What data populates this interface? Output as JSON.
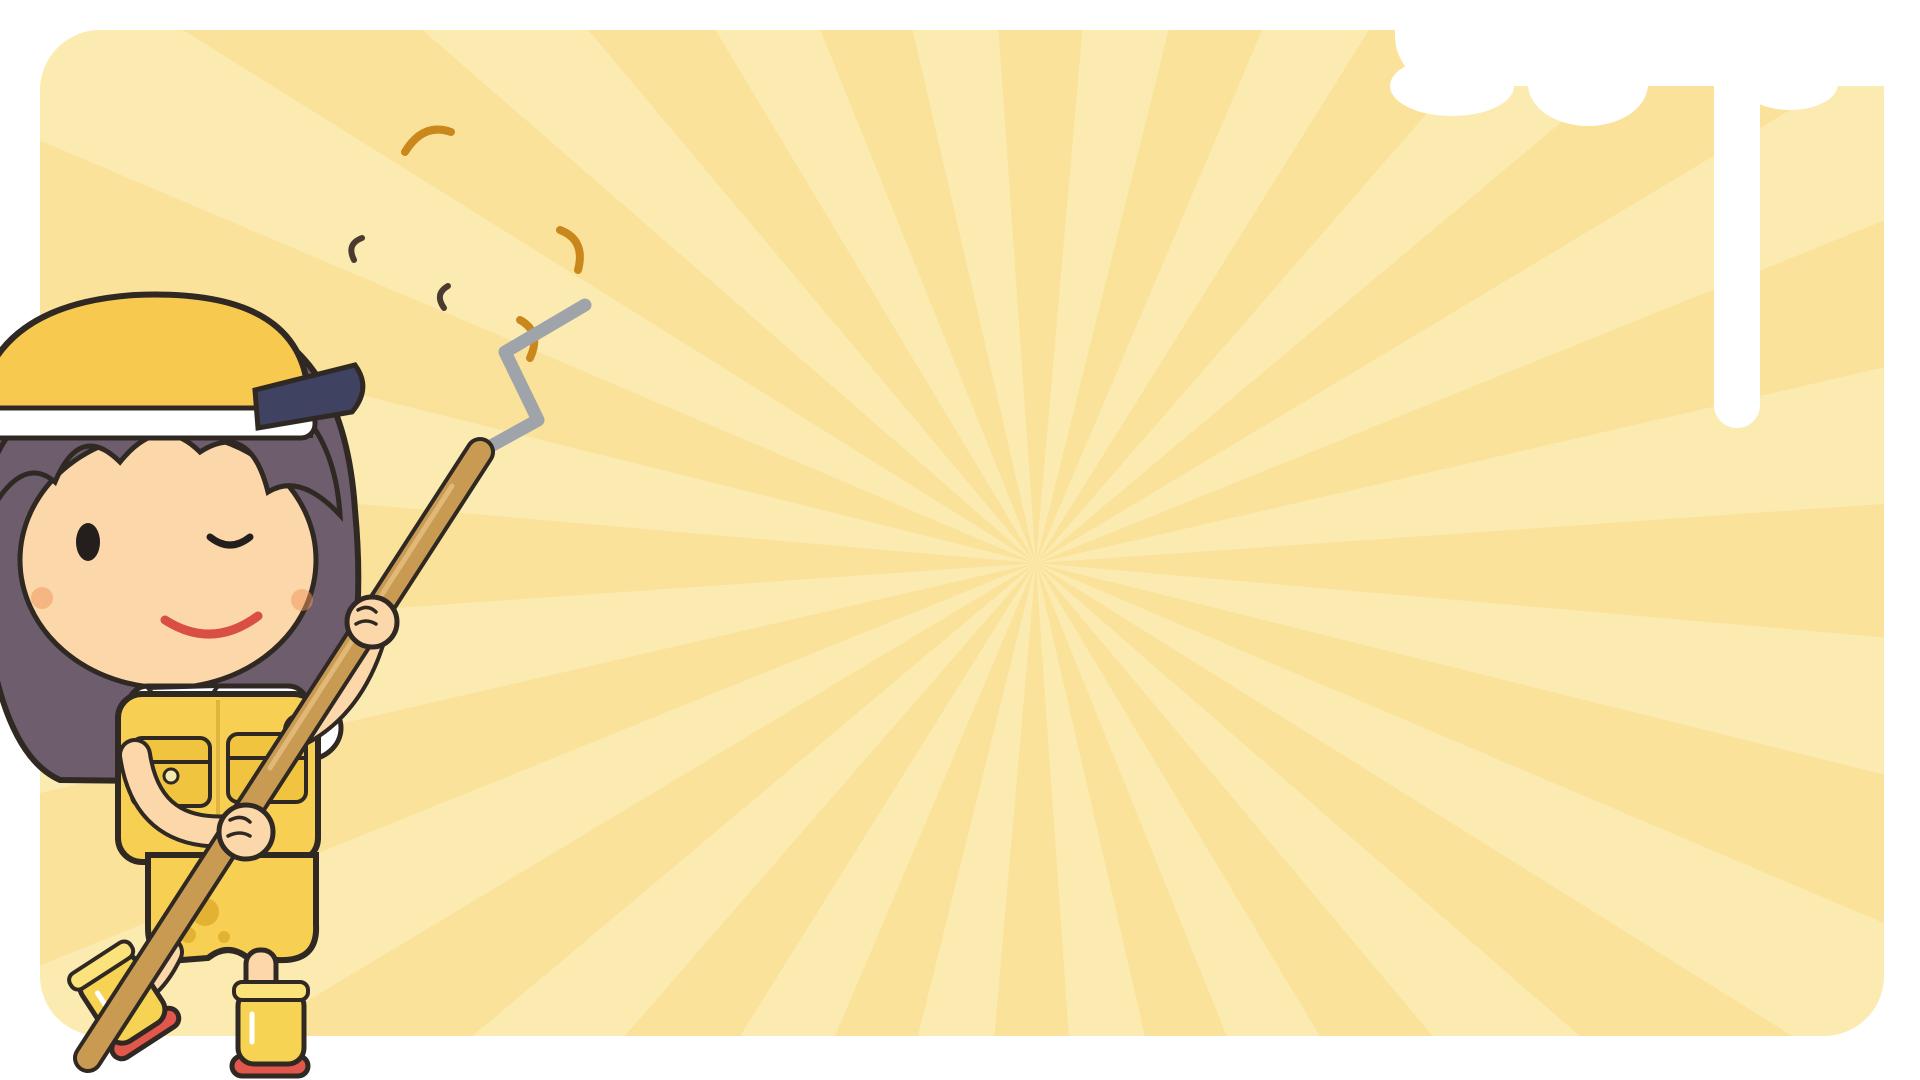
{
  "texts": {
    "happy": "HAPPY"
  },
  "colors": {
    "page_bg": "#ffffff",
    "panel_yellow": "#fbe29a",
    "panel_ray": "#fcebb0",
    "outline": "#2f2823",
    "accent_yellow": "#f6cf57",
    "wood": "#c98f4e",
    "copper": "#c0763a",
    "white": "#fcfbf5",
    "glass_blue": "#cdeaf4",
    "pink": "#f3a8c8",
    "teal": "#57cfa8",
    "grey": "#9aa2ad",
    "green": "#6fae4e",
    "boot_sole_red": "#e2574b",
    "hair_purple": "#6e5e6d",
    "skin": "#fcd7a9",
    "happy_green": "#2f9e3c"
  },
  "character": {
    "name": "painter-girl",
    "outfit": [
      "yellow-visor",
      "white-shirt",
      "yellow-overalls",
      "yellow-rain-boots"
    ],
    "holding": "paint-roller",
    "expression": "wink-smile"
  },
  "items": [
    {
      "n": "display-cabinet",
      "k": "glasscab",
      "x": 68,
      "y": 94,
      "w": 140,
      "h": 242
    },
    {
      "n": "table-lamp",
      "k": "lampT",
      "x": 196,
      "y": 110,
      "w": 48,
      "h": 66
    },
    {
      "n": "pendant-lamp",
      "k": "pendant",
      "x": 200,
      "y": 178,
      "w": 44,
      "h": 104
    },
    {
      "n": "lavender-vase",
      "k": "vasef",
      "x": 252,
      "y": 110,
      "w": 46,
      "h": 96,
      "p": {
        "t": "lav",
        "v": "#2e7d5b"
      }
    },
    {
      "n": "daisy-flower-stand",
      "k": "fstand",
      "x": 246,
      "y": 208,
      "w": 64,
      "h": 132
    },
    {
      "n": "large-tree",
      "k": "treeL",
      "x": 290,
      "y": 86,
      "w": 198,
      "h": 408
    },
    {
      "n": "hanging-plant",
      "k": "hplant",
      "x": 482,
      "y": 112,
      "w": 52,
      "h": 64
    },
    {
      "n": "arc-floor-lamp",
      "k": "lampArc",
      "x": 640,
      "y": 130,
      "w": 82,
      "h": 348
    },
    {
      "n": "hutch-cabinet",
      "k": "hutch",
      "x": 736,
      "y": 124,
      "w": 136,
      "h": 196
    },
    {
      "n": "garment-cart",
      "k": "cart",
      "x": 556,
      "y": 336,
      "w": 188,
      "h": 162
    },
    {
      "n": "high-chair",
      "k": "hichair",
      "x": 814,
      "y": 318,
      "w": 58,
      "h": 80
    },
    {
      "n": "pedestal-sink",
      "k": "psink",
      "x": 918,
      "y": 138,
      "w": 118,
      "h": 120
    },
    {
      "n": "shower-curtain-rail",
      "k": "srail",
      "x": 886,
      "y": 238,
      "w": 166,
      "h": 155
    },
    {
      "n": "window-cabinet",
      "k": "winunit",
      "x": 1066,
      "y": 146,
      "w": 170,
      "h": 97
    },
    {
      "n": "wooden-brush",
      "k": "tool",
      "x": 1078,
      "y": 250,
      "w": 58,
      "h": 28,
      "p": {
        "t": "spoonh"
      }
    },
    {
      "n": "toothpaste-purple",
      "k": "tube",
      "x": 1184,
      "y": 264,
      "w": 20,
      "h": 38,
      "p": {
        "c": "#8f7fd0"
      }
    },
    {
      "n": "toothpaste-pink",
      "k": "tube",
      "x": 1210,
      "y": 264,
      "w": 20,
      "h": 38,
      "p": {
        "c": "#e0568e"
      }
    },
    {
      "n": "oval-mirror",
      "k": "movel",
      "x": 1254,
      "y": 144,
      "w": 74,
      "h": 90,
      "p": {
        "dots": 1
      }
    },
    {
      "n": "flower-wreath",
      "k": "wreath",
      "x": 1342,
      "y": 150,
      "w": 56,
      "h": 74
    },
    {
      "n": "egg-pennant-banner",
      "k": "garland",
      "x": 1246,
      "y": 241,
      "w": 118,
      "h": 50,
      "p": {
        "t": "eggban"
      }
    },
    {
      "n": "daisy-frame-small",
      "k": "framer",
      "x": 1364,
      "y": 291,
      "w": 34,
      "h": 46,
      "p": {
        "f": "#ccd052",
        "t": "daisy"
      }
    },
    {
      "n": "detergent-blue",
      "k": "bottle",
      "x": 1238,
      "y": 300,
      "w": 36,
      "h": 54,
      "p": {
        "c": "#7fd0e8",
        "cap": "#d33f3f"
      }
    },
    {
      "n": "detergent-white",
      "k": "bottle",
      "x": 1282,
      "y": 296,
      "w": 42,
      "h": 58,
      "p": {
        "c": "#f2f6f8",
        "cap": "#e0568e"
      }
    },
    {
      "n": "soap-pump-brown",
      "k": "pump",
      "x": 1256,
      "y": 364,
      "w": 28,
      "h": 54,
      "p": {
        "c": "#cfae7c"
      }
    },
    {
      "n": "soap-pump-pink",
      "k": "pump",
      "x": 1298,
      "y": 369,
      "w": 28,
      "h": 50,
      "p": {
        "c": "#f3bfd3"
      }
    },
    {
      "n": "ladder-shelf",
      "k": "ladder",
      "x": 1418,
      "y": 154,
      "w": 80,
      "h": 182
    },
    {
      "n": "yellow-curtain",
      "k": "curtain",
      "x": 1532,
      "y": 124,
      "w": 80,
      "h": 312
    },
    {
      "n": "flower-clock",
      "k": "eggf",
      "x": 1642,
      "y": 140,
      "w": 60,
      "h": 60
    },
    {
      "n": "lace-shelf-trim",
      "k": "lace",
      "x": 1746,
      "y": 145,
      "w": 92,
      "h": 32
    },
    {
      "n": "toaster-oven",
      "k": "micro",
      "x": 1614,
      "y": 211,
      "w": 90,
      "h": 74
    },
    {
      "n": "wall-shelf-small",
      "k": "wshelf",
      "x": 1762,
      "y": 208,
      "w": 88,
      "h": 28
    },
    {
      "n": "wall-shelf-large",
      "k": "wshelf",
      "x": 1758,
      "y": 264,
      "w": 94,
      "h": 36
    },
    {
      "n": "egg-fluffy-rug",
      "k": "rug",
      "x": 1622,
      "y": 313,
      "w": 182,
      "h": 66,
      "p": {
        "t": "egg"
      }
    },
    {
      "n": "oval-frame-small",
      "k": "movel",
      "x": 1816,
      "y": 328,
      "w": 36,
      "h": 48,
      "p": {
        "fl": 1
      }
    },
    {
      "n": "hearts-frame",
      "k": "framer",
      "x": 1624,
      "y": 394,
      "w": 56,
      "h": 44,
      "p": {
        "f": "#7a4a32",
        "t": "hearts"
      }
    },
    {
      "n": "writing-desk",
      "k": "desk",
      "x": 1696,
      "y": 391,
      "w": 164,
      "h": 92
    },
    {
      "n": "star-rug",
      "k": "rug",
      "x": 1383,
      "y": 443,
      "w": 308,
      "h": 80,
      "p": {
        "t": "stars"
      }
    },
    {
      "n": "round-cloth-table",
      "k": "tround",
      "x": 1564,
      "y": 536,
      "w": 138,
      "h": 92
    },
    {
      "n": "bowl-blue",
      "k": "bowl",
      "x": 1710,
      "y": 516,
      "w": 42,
      "h": 30,
      "p": {
        "c": "#7f9fd6",
        "rim": "#ffffff"
      }
    },
    {
      "n": "bowl-teal",
      "k": "bowl",
      "x": 1712,
      "y": 564,
      "w": 44,
      "h": 32,
      "p": {
        "c": "#bfe3df",
        "rim": "#e8f4f2"
      }
    },
    {
      "n": "egg-art-box",
      "k": "boxart",
      "x": 1770,
      "y": 506,
      "w": 88,
      "h": 74
    },
    {
      "n": "egg-garland",
      "k": "garland",
      "x": 1684,
      "y": 594,
      "w": 174,
      "h": 54,
      "p": {
        "t": "eggs"
      }
    },
    {
      "n": "storage-box",
      "k": "boxs",
      "x": 1558,
      "y": 656,
      "w": 54,
      "h": 34
    },
    {
      "n": "daisy-rug",
      "k": "rug",
      "x": 1630,
      "y": 650,
      "w": 172,
      "h": 64,
      "p": {
        "t": "daisy"
      }
    },
    {
      "n": "laptop",
      "k": "laptop",
      "x": 1808,
      "y": 650,
      "w": 54,
      "h": 52
    },
    {
      "n": "pet-bed-yellow",
      "k": "petbed",
      "x": 1488,
      "y": 696,
      "w": 96,
      "h": 72,
      "p": {
        "t": "donut"
      }
    },
    {
      "n": "pansy-pot",
      "k": "vasef",
      "x": 1586,
      "y": 696,
      "w": 48,
      "h": 60,
      "p": {
        "t": "pansy",
        "v": "#f3b8cc"
      }
    },
    {
      "n": "pouf",
      "k": "petbed",
      "x": 1640,
      "y": 718,
      "w": 72,
      "h": 42,
      "p": {
        "t": "pouf"
      }
    },
    {
      "n": "towel-rail",
      "k": "rail",
      "x": 1748,
      "y": 728,
      "w": 112,
      "h": 32,
      "p": {
        "c": "#aeb8c2"
      }
    },
    {
      "n": "coat-rack",
      "k": "rail",
      "x": 1560,
      "y": 786,
      "w": 98,
      "h": 28,
      "p": {
        "c": "#cf9a58",
        "wood": 1
      }
    },
    {
      "n": "flower-mirror",
      "k": "mirf",
      "x": 1680,
      "y": 748,
      "w": 94,
      "h": 94
    },
    {
      "n": "lace-pillow",
      "k": "pillow",
      "x": 1796,
      "y": 790,
      "w": 58,
      "h": 50
    },
    {
      "n": "blue-pot",
      "k": "small",
      "x": 1602,
      "y": 826,
      "w": 28,
      "h": 26,
      "p": {
        "t": "pot"
      }
    },
    {
      "n": "two-tier-shelf",
      "k": "shelf2",
      "x": 1560,
      "y": 853,
      "w": 154,
      "h": 92
    },
    {
      "n": "wooden-display-box",
      "k": "sbox",
      "x": 1730,
      "y": 856,
      "w": 128,
      "h": 84
    },
    {
      "n": "wide-wall-mirror",
      "k": "sbox",
      "x": 1348,
      "y": 606,
      "w": 204,
      "h": 78,
      "p": {
        "g": "#b9b9b2"
      }
    },
    {
      "n": "fridge-yellow",
      "k": "fridge",
      "x": 1092,
      "y": 604,
      "w": 112,
      "h": 232
    },
    {
      "n": "vanity-sink",
      "k": "vanity",
      "x": 1044,
      "y": 290,
      "w": 152,
      "h": 172
    },
    {
      "n": "wall-cabinet",
      "k": "wallcab",
      "x": 1370,
      "y": 353,
      "w": 104,
      "h": 85
    },
    {
      "n": "step-stool",
      "k": "sstool",
      "x": 1244,
      "y": 420,
      "w": 104,
      "h": 102
    },
    {
      "n": "frying-pan",
      "k": "pan",
      "x": 1140,
      "y": 434,
      "w": 76,
      "h": 30
    },
    {
      "n": "washer-cream",
      "k": "washer",
      "x": 1146,
      "y": 468,
      "w": 86,
      "h": 110
    },
    {
      "n": "pink-jar",
      "k": "small",
      "x": 1370,
      "y": 534,
      "w": 34,
      "h": 28,
      "p": {
        "t": "jar"
      }
    },
    {
      "n": "lunchbox-pink",
      "k": "small",
      "x": 1366,
      "y": 564,
      "w": 46,
      "h": 32,
      "p": {
        "t": "lunch"
      }
    },
    {
      "n": "toy-ball",
      "k": "small",
      "x": 1418,
      "y": 572,
      "w": 22,
      "h": 22,
      "p": {
        "t": "ball"
      }
    },
    {
      "n": "mug-blue",
      "k": "cup",
      "x": 1436,
      "y": 530,
      "w": 34,
      "h": 34,
      "p": {
        "t": "mug",
        "c": "#8fb8e8"
      }
    },
    {
      "n": "mug-yellow",
      "k": "cup",
      "x": 1450,
      "y": 558,
      "w": 36,
      "h": 32,
      "p": {
        "t": "mug",
        "c": "#f6cf57"
      }
    },
    {
      "n": "toothbrush-pink",
      "k": "tool",
      "x": 1485,
      "y": 533,
      "w": 14,
      "h": 48,
      "p": {
        "t": "tbrush",
        "c": "#f08ab8"
      }
    },
    {
      "n": "toothbrush-yellow",
      "k": "tool",
      "x": 1507,
      "y": 533,
      "w": 14,
      "h": 48,
      "p": {
        "t": "tbrush",
        "c": "#e8c24e"
      }
    },
    {
      "n": "potted-tree",
      "k": "treeP",
      "x": 1246,
      "y": 550,
      "w": 112,
      "h": 150
    },
    {
      "n": "daisy-vase",
      "k": "vasef",
      "x": 1208,
      "y": 580,
      "w": 40,
      "h": 58,
      "p": {
        "t": "daisy",
        "v": "#eef3ee"
      }
    },
    {
      "n": "small-lamp",
      "k": "lampT",
      "x": 1208,
      "y": 660,
      "w": 46,
      "h": 58,
      "p": {
        "sh": "#f6cf57",
        "b": "#e8955c"
      }
    },
    {
      "n": "wooden-bench",
      "k": "bench",
      "x": 1328,
      "y": 706,
      "w": 152,
      "h": 62
    },
    {
      "n": "pennant-banner-blue",
      "k": "garland",
      "x": 1394,
      "y": 784,
      "w": 116,
      "h": 46,
      "p": {
        "t": "bluyel"
      }
    },
    {
      "n": "happy-garland",
      "k": "garland",
      "x": 1364,
      "y": 820,
      "w": 190,
      "h": 62,
      "p": {
        "t": "happy"
      }
    },
    {
      "n": "stove-oven",
      "k": "stove",
      "x": 1208,
      "y": 738,
      "w": 116,
      "h": 204
    },
    {
      "n": "kitchen-sink-cabinet",
      "k": "sinkcab",
      "x": 998,
      "y": 806,
      "w": 180,
      "h": 138
    },
    {
      "n": "pedestal-side-table",
      "k": "tped",
      "x": 1328,
      "y": 854,
      "w": 52,
      "h": 42
    },
    {
      "n": "saucepan",
      "k": "sauce",
      "x": 1336,
      "y": 904,
      "w": 82,
      "h": 42
    },
    {
      "n": "pink-sponge",
      "k": "small",
      "x": 1430,
      "y": 884,
      "w": 32,
      "h": 22,
      "p": {
        "t": "sponge"
      }
    },
    {
      "n": "plate-blue",
      "k": "bowl",
      "x": 1484,
      "y": 878,
      "w": 56,
      "h": 22,
      "p": {
        "flat": 1,
        "c": "#fdfdf6",
        "in": "#cfe0f0"
      }
    },
    {
      "n": "bowl-yellow",
      "k": "bowl",
      "x": 1420,
      "y": 918,
      "w": 52,
      "h": 24,
      "p": {
        "c": "#f6cf57",
        "rim": "#e8f0f2"
      }
    },
    {
      "n": "plate-yellow",
      "k": "bowl",
      "x": 1486,
      "y": 912,
      "w": 48,
      "h": 28,
      "p": {
        "flat": 1,
        "c": "#fdfdf6",
        "in": "#f6cf57"
      }
    },
    {
      "n": "toilet",
      "k": "toilet",
      "x": 1068,
      "y": 461,
      "w": 60,
      "h": 114
    },
    {
      "n": "armchair-yellow",
      "k": "chair",
      "x": 848,
      "y": 490,
      "w": 112,
      "h": 174
    },
    {
      "n": "stand-mixer",
      "k": "mixer",
      "x": 978,
      "y": 490,
      "w": 48,
      "h": 82
    },
    {
      "n": "soap-dish",
      "k": "dishk",
      "x": 968,
      "y": 548,
      "w": 58,
      "h": 32
    },
    {
      "n": "hoop-daisy",
      "k": "hoop",
      "x": 1032,
      "y": 563,
      "w": 44,
      "h": 52,
      "p": {
        "t": "daisy"
      }
    },
    {
      "n": "hoop-dots",
      "k": "hoop",
      "x": 982,
      "y": 594,
      "w": 46,
      "h": 54,
      "p": {
        "t": "dots"
      }
    },
    {
      "n": "striped-cup",
      "k": "cup",
      "x": 1042,
      "y": 625,
      "w": 30,
      "h": 30,
      "p": {
        "t": "tilt"
      }
    },
    {
      "n": "table-blue",
      "k": "table4",
      "x": 838,
      "y": 608,
      "w": 128,
      "h": 86
    },
    {
      "n": "washer-dark",
      "k": "washer",
      "x": 668,
      "y": 488,
      "w": 88,
      "h": 106,
      "p": {
        "dark": 1
      }
    },
    {
      "n": "mug-pink",
      "k": "cup",
      "x": 613,
      "y": 493,
      "w": 32,
      "h": 32,
      "p": {
        "t": "mug",
        "c": "#f3a8c8"
      }
    },
    {
      "n": "teacup-dotted",
      "k": "cup",
      "x": 608,
      "y": 542,
      "w": 38,
      "h": 32,
      "p": {
        "t": "tea",
        "c": "#fdfdf6"
      }
    },
    {
      "n": "teacup-pink",
      "k": "cup",
      "x": 606,
      "y": 588,
      "w": 40,
      "h": 34,
      "p": {
        "t": "tea",
        "c": "#f3a8c8"
      }
    },
    {
      "n": "rice-cooker",
      "k": "ricec",
      "x": 446,
      "y": 526,
      "w": 46,
      "h": 48
    },
    {
      "n": "nightstand",
      "k": "nstand",
      "x": 423,
      "y": 588,
      "w": 90,
      "h": 80
    },
    {
      "n": "twin-floor-lamp",
      "k": "lamp2",
      "x": 528,
      "y": 500,
      "w": 66,
      "h": 148
    },
    {
      "n": "plaid-rug-blue",
      "k": "rug",
      "x": 596,
      "y": 620,
      "w": 224,
      "h": 70,
      "p": {
        "t": "plaid"
      }
    },
    {
      "n": "daisy-planter",
      "k": "planter",
      "x": 620,
      "y": 688,
      "w": 90,
      "h": 54
    },
    {
      "n": "pet-chair-pink",
      "k": "petbed",
      "x": 656,
      "y": 713,
      "w": 126,
      "h": 94,
      "p": {
        "t": "pinkchair"
      }
    },
    {
      "n": "egg-clock",
      "k": "clockegg",
      "x": 748,
      "y": 808,
      "w": 54,
      "h": 56
    },
    {
      "n": "bookshelf",
      "k": "bookshelf",
      "x": 808,
      "y": 706,
      "w": 164,
      "h": 300
    },
    {
      "n": "sofa-yellow",
      "k": "sofa",
      "x": 556,
      "y": 850,
      "w": 224,
      "h": 154
    },
    {
      "n": "standing-mirror",
      "k": "mirst",
      "x": 402,
      "y": 796,
      "w": 72,
      "h": 208
    },
    {
      "n": "doll-bed",
      "k": "dollbed",
      "x": 280,
      "y": 796,
      "w": 142,
      "h": 212
    },
    {
      "n": "tv-stand",
      "k": "tvstand",
      "x": 420,
      "y": 680,
      "w": 154,
      "h": 82
    },
    {
      "n": "low-table",
      "k": "tlow",
      "x": 478,
      "y": 788,
      "w": 150,
      "h": 36
    },
    {
      "n": "small-stool-table",
      "k": "stoolsm",
      "x": 614,
      "y": 880,
      "w": 60,
      "h": 120
    },
    {
      "n": "wooden-spoon",
      "k": "tool",
      "x": 968,
      "y": 653,
      "w": 32,
      "h": 62,
      "p": {
        "t": "spoon"
      }
    },
    {
      "n": "kitchen-knife",
      "k": "tool",
      "x": 1004,
      "y": 652,
      "w": 24,
      "h": 54,
      "p": {
        "t": "knife"
      }
    },
    {
      "n": "yellow-cloth",
      "k": "tool",
      "x": 1040,
      "y": 672,
      "w": 36,
      "h": 46,
      "p": {
        "t": "cloth"
      }
    },
    {
      "n": "plunger",
      "k": "tool",
      "x": 976,
      "y": 714,
      "w": 32,
      "h": 62,
      "p": {
        "t": "plunge"
      }
    },
    {
      "n": "cutting-board",
      "k": "tool",
      "x": 1008,
      "y": 724,
      "w": 76,
      "h": 36,
      "p": {
        "t": "board"
      }
    },
    {
      "n": "cleaning-brush",
      "k": "tool",
      "x": 1028,
      "y": 766,
      "w": 52,
      "h": 26,
      "p": {
        "t": "brush"
      }
    },
    {
      "n": "spatula",
      "k": "tool",
      "x": 972,
      "y": 784,
      "w": 52,
      "h": 24,
      "p": {
        "t": "spat"
      }
    },
    {
      "n": "chandelier",
      "k": "chand",
      "x": 750,
      "y": 366,
      "w": 54,
      "h": 104
    },
    {
      "n": "daisy-stool",
      "k": "stoolf",
      "x": 820,
      "y": 416,
      "w": 60,
      "h": 62,
      "p": {
        "t": "daisy"
      }
    },
    {
      "n": "bathtub",
      "k": "tub",
      "x": 898,
      "y": 356,
      "w": 174,
      "h": 120
    },
    {
      "n": "stool-pink-plaid",
      "k": "stoolf",
      "x": 780,
      "y": 493,
      "w": 54,
      "h": 54,
      "p": {
        "t": "plaid"
      }
    },
    {
      "n": "daisy-frame-large",
      "k": "framer",
      "x": 780,
      "y": 554,
      "w": 52,
      "h": 64,
      "p": {
        "f": "#fdfdf6",
        "t": "daisy"
      }
    },
    {
      "n": "egg-flower-deco",
      "k": "eggf",
      "x": 573,
      "y": 390,
      "w": 38,
      "h": 34
    },
    {
      "n": "sheer-curtain",
      "k": "curtain",
      "x": 34,
      "y": 750,
      "w": 114,
      "h": 266,
      "p": {
        "sheer": 1
      }
    },
    {
      "n": "paint-bucket",
      "k": "bucket",
      "x": -10,
      "y": 898,
      "w": 180,
      "h": 185,
      "p": {
        "z": 50
      }
    }
  ]
}
